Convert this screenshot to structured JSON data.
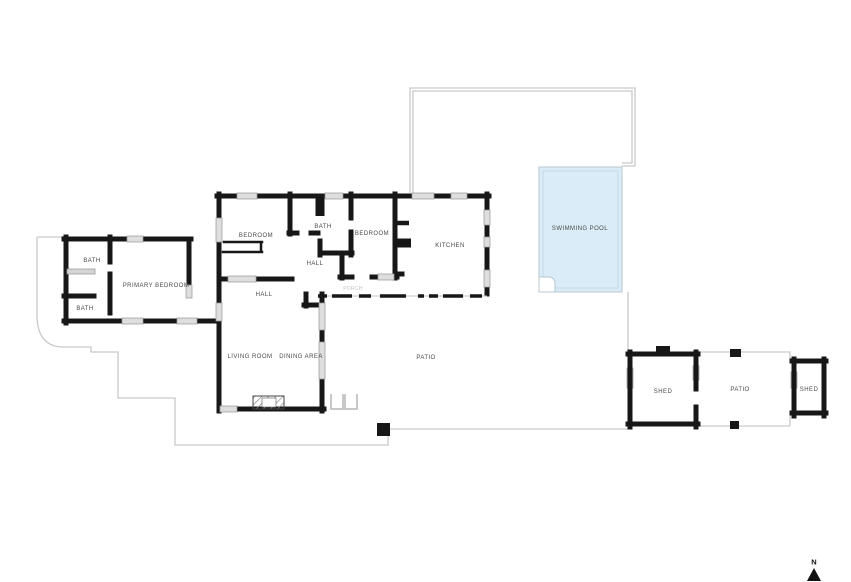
{
  "plan": {
    "compass": {
      "label": "N"
    },
    "colors": {
      "wall": "#171717",
      "lot_line": "#c9c9c9",
      "pool_fill": "#daecf7",
      "pool_border": "#b8c7d1",
      "window_fill": "#dedede",
      "window_border": "#9b9b9b",
      "label_text": "#4a4a4a"
    },
    "rooms": [
      {
        "id": "bedroom-1",
        "label": "BEDROOM",
        "x": 256,
        "y": 236
      },
      {
        "id": "bath-hall",
        "label": "BATH",
        "x": 323,
        "y": 227
      },
      {
        "id": "bedroom-2",
        "label": "BEDROOM",
        "x": 372,
        "y": 234
      },
      {
        "id": "kitchen",
        "label": "KITCHEN",
        "x": 450,
        "y": 246
      },
      {
        "id": "swimming-pool",
        "label": "SWIMMING POOL",
        "x": 580,
        "y": 229
      },
      {
        "id": "bath-front",
        "label": "BATH",
        "x": 92,
        "y": 261
      },
      {
        "id": "bath-rear",
        "label": "BATH",
        "x": 85,
        "y": 309
      },
      {
        "id": "primary-bedroom",
        "label": "PRIMARY BEDROOM",
        "x": 156,
        "y": 286
      },
      {
        "id": "hall-upper",
        "label": "HALL",
        "x": 315,
        "y": 264
      },
      {
        "id": "hall-lower",
        "label": "HALL",
        "x": 264,
        "y": 295
      },
      {
        "id": "porch",
        "label": "PORCH",
        "x": 353,
        "y": 289,
        "muted": true
      },
      {
        "id": "living-room",
        "label": "LIVING ROOM",
        "x": 250,
        "y": 357
      },
      {
        "id": "dining-area",
        "label": "DINING AREA",
        "x": 301,
        "y": 357
      },
      {
        "id": "patio-main",
        "label": "PATIO",
        "x": 426,
        "y": 358
      },
      {
        "id": "shed-west",
        "label": "SHED",
        "x": 663,
        "y": 392
      },
      {
        "id": "patio-east",
        "label": "PATIO",
        "x": 740,
        "y": 390
      },
      {
        "id": "shed-east",
        "label": "SHED",
        "x": 809,
        "y": 390
      }
    ]
  }
}
